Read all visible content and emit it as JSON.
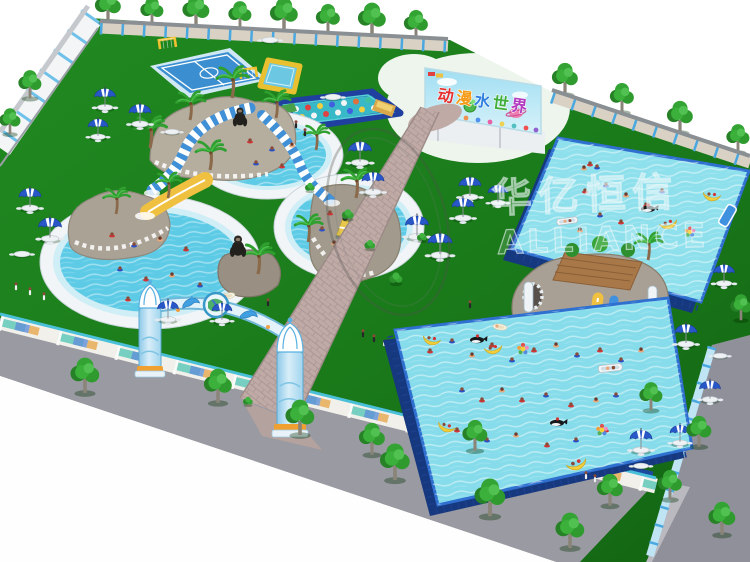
{
  "meta": {
    "description": "Aerial 3D rendering of an inflatable amusement water park with round slide pools, metal frame pools, entrance arch and picnic umbrellas",
    "image_type": "3d-render"
  },
  "billboard": {
    "title": "动漫水世界",
    "chars": [
      "动",
      "漫",
      "水",
      "世",
      "界"
    ],
    "char_colors": [
      "#e53030",
      "#f59a16",
      "#2f7fe0",
      "#3fae3a",
      "#b23ac0"
    ]
  },
  "watermark": {
    "line1": "华亿恒信",
    "line2": "ALLIANCE"
  },
  "palette": {
    "background": "#ffffff",
    "grass": "#1b7a1b",
    "frame_pool_water": "#86dcea",
    "round_pool_water": "#5ecbe6",
    "pool_frame_blue": "#2e6fd0",
    "pool_wall_navy": "#16387e",
    "path_gray_pink": "#bfaaa6",
    "road_gray": "#95959d",
    "fence_blue": "#4aa8e0",
    "umbrella_blue": "#2857c8",
    "tree_green": "#2e8b2e",
    "slide_yellow": "#f0c040",
    "stone_gray": "#aaa296",
    "billboard_sky": "#8fd8f0"
  },
  "areas": [
    "left-round-pool-slide-complex",
    "inflatable-sports-court",
    "obstacle-course",
    "billboard",
    "top-frame-pool",
    "front-frame-pool",
    "slide-castle",
    "dolphin-entrance-arch",
    "paved-path",
    "perimeter-fence",
    "picnic-umbrellas"
  ]
}
